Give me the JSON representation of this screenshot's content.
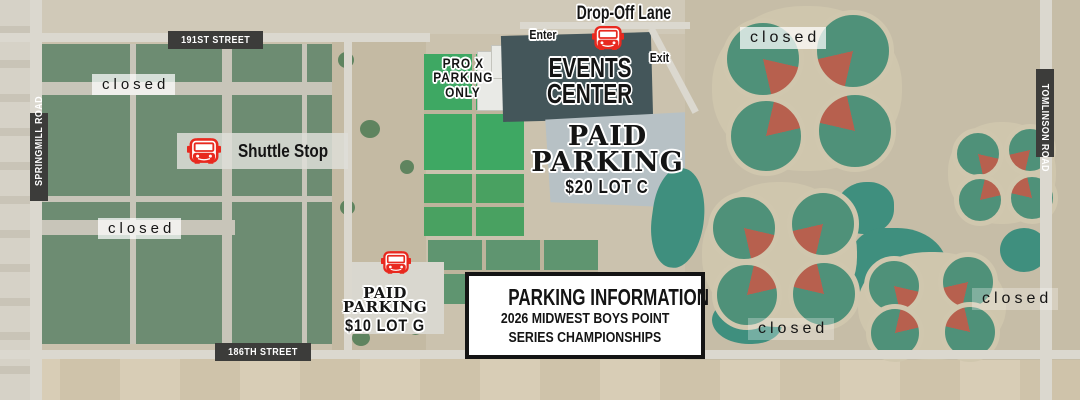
{
  "roads": {
    "street_191": "191ST STREET",
    "street_186": "186TH STREET",
    "springmill": "SPRINGMILL ROAD",
    "tomlinson": "TOMLINSON ROAD"
  },
  "venue": {
    "drop_off_lane": "Drop-Off Lane",
    "enter": "Enter",
    "exit": "Exit",
    "events_center": [
      "EVENTS",
      "CENTER"
    ],
    "pro_x": [
      "PRO X",
      "PARKING",
      "ONLY"
    ]
  },
  "parking": {
    "shuttle_stop": "Shuttle Stop",
    "closed": "closed",
    "lot_c": {
      "title1": "PAID",
      "title2": "PARKING",
      "price": "$20 LOT C"
    },
    "lot_g": {
      "title1": "PAID",
      "title2": "PARKING",
      "price": "$10 LOT G"
    }
  },
  "info_box": {
    "title": "PARKING INFORMATION",
    "line1": "2026 MIDWEST BOYS POINT",
    "line2": "SERIES CHAMPIONSHIPS"
  },
  "icons": {
    "bus": "red-front-facing-shuttle-bus"
  },
  "colors": {
    "bus_red": "#e8291f",
    "road_label_bg": "#3c3c3a",
    "road_label_text": "#ffffff",
    "closed_label_bg": "#ffffff",
    "label_text": "#141414",
    "info_box_border": "#141414",
    "info_box_bg": "#ffffff",
    "field_green": "#6d8c72",
    "turf_green": "#3ea863",
    "pond_teal": "#3f8f7e",
    "infield_red": "#b7604e"
  }
}
